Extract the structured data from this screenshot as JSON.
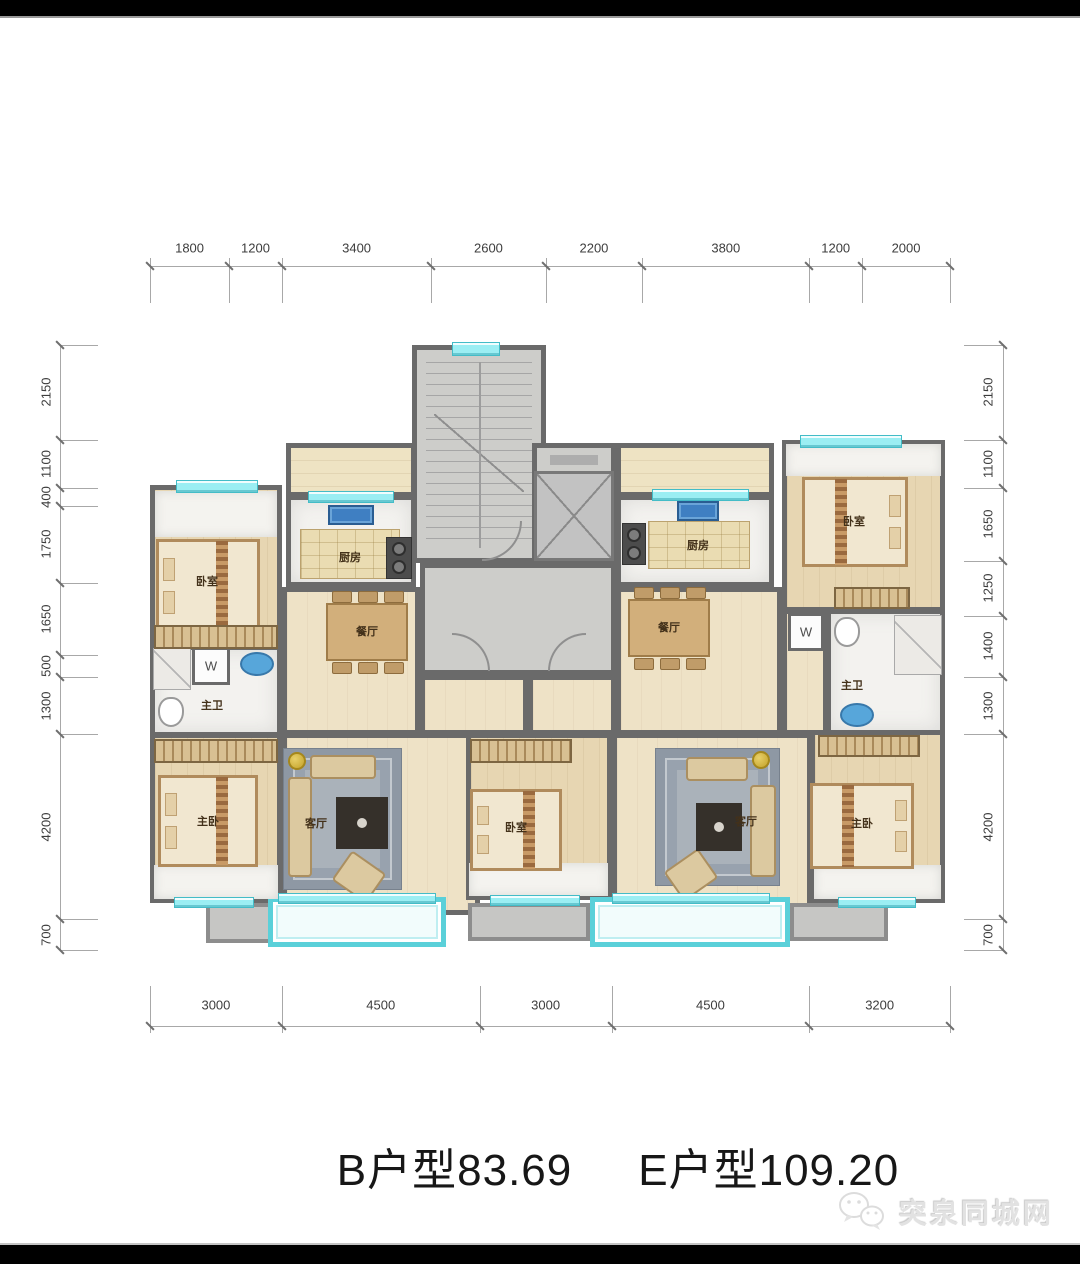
{
  "title": {
    "left": "B户型83.69",
    "right": "E户型109.20"
  },
  "watermark": {
    "text": "突泉同城网",
    "icon": "wechat-bubbles-icon"
  },
  "colors": {
    "wall": "#6a6a6a",
    "window": "#9beef3",
    "wood": "#e7d6b2",
    "marble": "#f3f2ef",
    "corridor": "#cdcdca",
    "balcony_frame": "#5ad0d9",
    "title_text": "#171717"
  },
  "dimensions": {
    "top": [
      "1800",
      "1200",
      "3400",
      "2600",
      "2200",
      "3800",
      "1200",
      "2000"
    ],
    "bottom": [
      "3000",
      "4500",
      "3000",
      "4500",
      "3200"
    ],
    "left": [
      "2150",
      "1100",
      "400",
      "1750",
      "1650",
      "500",
      "1300",
      "4200",
      "700"
    ],
    "right": [
      "2150",
      "1100",
      "1650",
      "1250",
      "1400",
      "1300",
      "4200",
      "700"
    ]
  },
  "plan": {
    "rooms": [
      {
        "id": "stairwell",
        "floor": "gray",
        "x": 262,
        "y": 0,
        "w": 134,
        "h": 218
      },
      {
        "id": "elevator-lobby",
        "floor": "gray",
        "x": 382,
        "y": 98,
        "w": 84,
        "h": 120
      },
      {
        "id": "corridor",
        "floor": "gray",
        "x": 270,
        "y": 218,
        "w": 196,
        "h": 112
      },
      {
        "id": "entry-hall-left",
        "floor": "wood-light",
        "x": 270,
        "y": 330,
        "w": 108,
        "h": 60
      },
      {
        "id": "entry-hall-right",
        "floor": "wood-light",
        "x": 378,
        "y": 330,
        "w": 88,
        "h": 60
      },
      {
        "id": "kitchen-balcony-left",
        "floor": "balcony-beige",
        "x": 136,
        "y": 98,
        "w": 130,
        "h": 54
      },
      {
        "id": "kitchen-left",
        "floor": "marble",
        "x": 136,
        "y": 150,
        "w": 130,
        "h": 92
      },
      {
        "id": "hall-left",
        "floor": "wood-light",
        "x": 132,
        "y": 242,
        "w": 138,
        "h": 148
      },
      {
        "id": "bedroom-top-left",
        "floor": "wood",
        "x": 0,
        "y": 140,
        "w": 132,
        "h": 170
      },
      {
        "id": "bath-left",
        "floor": "marble",
        "x": 0,
        "y": 300,
        "w": 132,
        "h": 92
      },
      {
        "id": "w-closet-left",
        "floor": "white",
        "x": 42,
        "y": 302,
        "w": 38,
        "h": 38
      },
      {
        "id": "master-left",
        "floor": "wood",
        "x": 0,
        "y": 388,
        "w": 132,
        "h": 170
      },
      {
        "id": "living-left",
        "floor": "wood-light",
        "x": 132,
        "y": 388,
        "w": 198,
        "h": 182
      },
      {
        "id": "bedroom-mid",
        "floor": "wood",
        "x": 316,
        "y": 388,
        "w": 146,
        "h": 167
      },
      {
        "id": "kitchen-balcony-right",
        "floor": "balcony-beige",
        "x": 466,
        "y": 98,
        "w": 158,
        "h": 54
      },
      {
        "id": "kitchen-right",
        "floor": "marble",
        "x": 466,
        "y": 150,
        "w": 158,
        "h": 92
      },
      {
        "id": "hall-right",
        "floor": "wood-light",
        "x": 466,
        "y": 242,
        "w": 166,
        "h": 148
      },
      {
        "id": "hall-right-ext",
        "floor": "wood-light",
        "x": 632,
        "y": 264,
        "w": 46,
        "h": 126
      },
      {
        "id": "bedroom-top-right",
        "floor": "wood",
        "x": 632,
        "y": 95,
        "w": 163,
        "h": 172
      },
      {
        "id": "w-closet-right",
        "floor": "white",
        "x": 638,
        "y": 268,
        "w": 36,
        "h": 38
      },
      {
        "id": "bath-right",
        "floor": "marble",
        "x": 676,
        "y": 264,
        "w": 119,
        "h": 126
      },
      {
        "id": "living-right",
        "floor": "wood-light",
        "x": 462,
        "y": 388,
        "w": 200,
        "h": 182
      },
      {
        "id": "master-right",
        "floor": "wood",
        "x": 660,
        "y": 385,
        "w": 135,
        "h": 173
      },
      {
        "id": "balcony-gray-left",
        "floor": "balcony-gray",
        "x": 56,
        "y": 558,
        "w": 76,
        "h": 40
      },
      {
        "id": "balcony-cyan-left",
        "floor": "balcony-cyan",
        "x": 118,
        "y": 552,
        "w": 178,
        "h": 50
      },
      {
        "id": "balcony-gray-mid",
        "floor": "balcony-gray",
        "x": 318,
        "y": 558,
        "w": 122,
        "h": 38
      },
      {
        "id": "balcony-cyan-right",
        "floor": "balcony-cyan",
        "x": 440,
        "y": 552,
        "w": 200,
        "h": 50
      },
      {
        "id": "balcony-gray-right",
        "floor": "balcony-gray",
        "x": 640,
        "y": 558,
        "w": 98,
        "h": 38
      }
    ],
    "windows": [
      {
        "x": 302,
        "y": -3,
        "w": 46,
        "h": 12
      },
      {
        "x": 26,
        "y": 135,
        "w": 80,
        "h": 11
      },
      {
        "x": 158,
        "y": 146,
        "w": 84,
        "h": 10
      },
      {
        "x": 502,
        "y": 144,
        "w": 95,
        "h": 10
      },
      {
        "x": 650,
        "y": 90,
        "w": 100,
        "h": 11
      },
      {
        "x": 24,
        "y": 552,
        "w": 78,
        "h": 9
      },
      {
        "x": 128,
        "y": 548,
        "w": 156,
        "h": 9
      },
      {
        "x": 340,
        "y": 550,
        "w": 88,
        "h": 9
      },
      {
        "x": 462,
        "y": 548,
        "w": 156,
        "h": 9
      },
      {
        "x": 688,
        "y": 552,
        "w": 76,
        "h": 9
      }
    ],
    "furniture": [
      {
        "t": "mstrip",
        "x": 5,
        "y": 146,
        "w": 122,
        "h": 46
      },
      {
        "t": "mstrip",
        "x": 636,
        "y": 99,
        "w": 155,
        "h": 32
      },
      {
        "t": "mstrip",
        "x": 4,
        "y": 520,
        "w": 124,
        "h": 34
      },
      {
        "t": "mstrip",
        "x": 319,
        "y": 518,
        "w": 139,
        "h": 33
      },
      {
        "t": "mstrip",
        "x": 664,
        "y": 520,
        "w": 127,
        "h": 34
      },
      {
        "t": "bed",
        "x": 6,
        "y": 194,
        "w": 104,
        "h": 94,
        "p": "left"
      },
      {
        "t": "bed",
        "x": 8,
        "y": 430,
        "w": 100,
        "h": 92,
        "p": "left"
      },
      {
        "t": "bed",
        "x": 320,
        "y": 444,
        "w": 92,
        "h": 82,
        "p": "left"
      },
      {
        "t": "bed",
        "x": 652,
        "y": 132,
        "w": 106,
        "h": 90,
        "p": "right"
      },
      {
        "t": "bed",
        "x": 660,
        "y": 438,
        "w": 104,
        "h": 86,
        "p": "right"
      },
      {
        "t": "wardrobe",
        "x": 4,
        "y": 280,
        "w": 124,
        "h": 24
      },
      {
        "t": "wardrobe",
        "x": 4,
        "y": 394,
        "w": 124,
        "h": 24
      },
      {
        "t": "wardrobe",
        "x": 320,
        "y": 394,
        "w": 102,
        "h": 24
      },
      {
        "t": "wardrobe",
        "x": 684,
        "y": 242,
        "w": 76,
        "h": 22
      },
      {
        "t": "wardrobe",
        "x": 668,
        "y": 390,
        "w": 102,
        "h": 22
      },
      {
        "t": "rug",
        "x": 134,
        "y": 404,
        "w": 117,
        "h": 140
      },
      {
        "t": "rug",
        "x": 506,
        "y": 404,
        "w": 123,
        "h": 136
      },
      {
        "t": "tv",
        "x": 186,
        "y": 452,
        "w": 52,
        "h": 52
      },
      {
        "t": "tv",
        "x": 546,
        "y": 458,
        "w": 46,
        "h": 48
      },
      {
        "t": "sofa-h",
        "x": 160,
        "y": 410,
        "w": 66,
        "h": 24
      },
      {
        "t": "sofa-v",
        "x": 138,
        "y": 432,
        "w": 24,
        "h": 100
      },
      {
        "t": "sofa-h",
        "x": 536,
        "y": 412,
        "w": 62,
        "h": 24
      },
      {
        "t": "sofa-v",
        "x": 600,
        "y": 440,
        "w": 26,
        "h": 92
      },
      {
        "t": "armchair",
        "x": 188,
        "y": 514,
        "w": 42,
        "h": 36,
        "r": 35
      },
      {
        "t": "armchair",
        "x": 520,
        "y": 512,
        "w": 42,
        "h": 36,
        "r": -35
      },
      {
        "t": "lamp",
        "x": 138,
        "y": 407,
        "w": 18,
        "h": 18
      },
      {
        "t": "lamp",
        "x": 602,
        "y": 406,
        "w": 18,
        "h": 18
      },
      {
        "t": "table",
        "x": 176,
        "y": 258,
        "w": 82,
        "h": 58
      },
      {
        "t": "chair",
        "x": 182,
        "y": 246,
        "w": 20,
        "h": 12
      },
      {
        "t": "chair",
        "x": 208,
        "y": 246,
        "w": 20,
        "h": 12
      },
      {
        "t": "chair",
        "x": 234,
        "y": 246,
        "w": 20,
        "h": 12
      },
      {
        "t": "chair",
        "x": 182,
        "y": 317,
        "w": 20,
        "h": 12
      },
      {
        "t": "chair",
        "x": 208,
        "y": 317,
        "w": 20,
        "h": 12
      },
      {
        "t": "chair",
        "x": 234,
        "y": 317,
        "w": 20,
        "h": 12
      },
      {
        "t": "table",
        "x": 478,
        "y": 254,
        "w": 82,
        "h": 58
      },
      {
        "t": "chair",
        "x": 484,
        "y": 242,
        "w": 20,
        "h": 12
      },
      {
        "t": "chair",
        "x": 510,
        "y": 242,
        "w": 20,
        "h": 12
      },
      {
        "t": "chair",
        "x": 536,
        "y": 242,
        "w": 20,
        "h": 12
      },
      {
        "t": "chair",
        "x": 484,
        "y": 313,
        "w": 20,
        "h": 12
      },
      {
        "t": "chair",
        "x": 510,
        "y": 313,
        "w": 20,
        "h": 12
      },
      {
        "t": "chair",
        "x": 536,
        "y": 313,
        "w": 20,
        "h": 12
      },
      {
        "t": "island",
        "x": 150,
        "y": 184,
        "w": 100,
        "h": 50
      },
      {
        "t": "sink",
        "x": 178,
        "y": 160,
        "w": 46,
        "h": 20
      },
      {
        "t": "stove",
        "x": 236,
        "y": 192,
        "w": 26,
        "h": 42
      },
      {
        "t": "island",
        "x": 498,
        "y": 176,
        "w": 102,
        "h": 48
      },
      {
        "t": "sink",
        "x": 527,
        "y": 156,
        "w": 42,
        "h": 20
      },
      {
        "t": "stove",
        "x": 472,
        "y": 178,
        "w": 24,
        "h": 42
      },
      {
        "t": "shower",
        "x": 3,
        "y": 303,
        "w": 38,
        "h": 42
      },
      {
        "t": "sink-round",
        "x": 90,
        "y": 307,
        "w": 34,
        "h": 24
      },
      {
        "t": "toilet",
        "x": 8,
        "y": 352,
        "w": 26,
        "h": 30
      },
      {
        "t": "toilet",
        "x": 684,
        "y": 272,
        "w": 26,
        "h": 30
      },
      {
        "t": "shower",
        "x": 744,
        "y": 270,
        "w": 48,
        "h": 60
      },
      {
        "t": "sink-round",
        "x": 690,
        "y": 358,
        "w": 34,
        "h": 24
      },
      {
        "t": "elevator",
        "x": 384,
        "y": 126,
        "w": 80,
        "h": 90
      },
      {
        "t": "sign",
        "x": 400,
        "y": 110,
        "w": 48,
        "h": 10
      }
    ],
    "labels": [
      {
        "text": "卧室",
        "x": 57,
        "y": 236
      },
      {
        "text": "厨房",
        "x": 200,
        "y": 212
      },
      {
        "text": "餐厅",
        "x": 217,
        "y": 286
      },
      {
        "text": "主卫",
        "x": 62,
        "y": 360
      },
      {
        "text": "W",
        "x": 61,
        "y": 321,
        "cls": "w"
      },
      {
        "text": "主卧",
        "x": 58,
        "y": 476
      },
      {
        "text": "客厅",
        "x": 166,
        "y": 478
      },
      {
        "text": "卧室",
        "x": 366,
        "y": 482
      },
      {
        "text": "厨房",
        "x": 548,
        "y": 200
      },
      {
        "text": "餐厅",
        "x": 519,
        "y": 282
      },
      {
        "text": "卧室",
        "x": 704,
        "y": 176
      },
      {
        "text": "W",
        "x": 656,
        "y": 287,
        "cls": "w"
      },
      {
        "text": "主卫",
        "x": 702,
        "y": 340
      },
      {
        "text": "客厅",
        "x": 596,
        "y": 476
      },
      {
        "text": "主卧",
        "x": 712,
        "y": 478
      }
    ],
    "doors": [
      {
        "x": 302,
        "y": 288,
        "s": 38,
        "flip": true
      },
      {
        "x": 398,
        "y": 288,
        "s": 38,
        "flip": false
      },
      {
        "x": 332,
        "y": 176,
        "s": 40,
        "flip": false,
        "r": 180
      }
    ]
  }
}
